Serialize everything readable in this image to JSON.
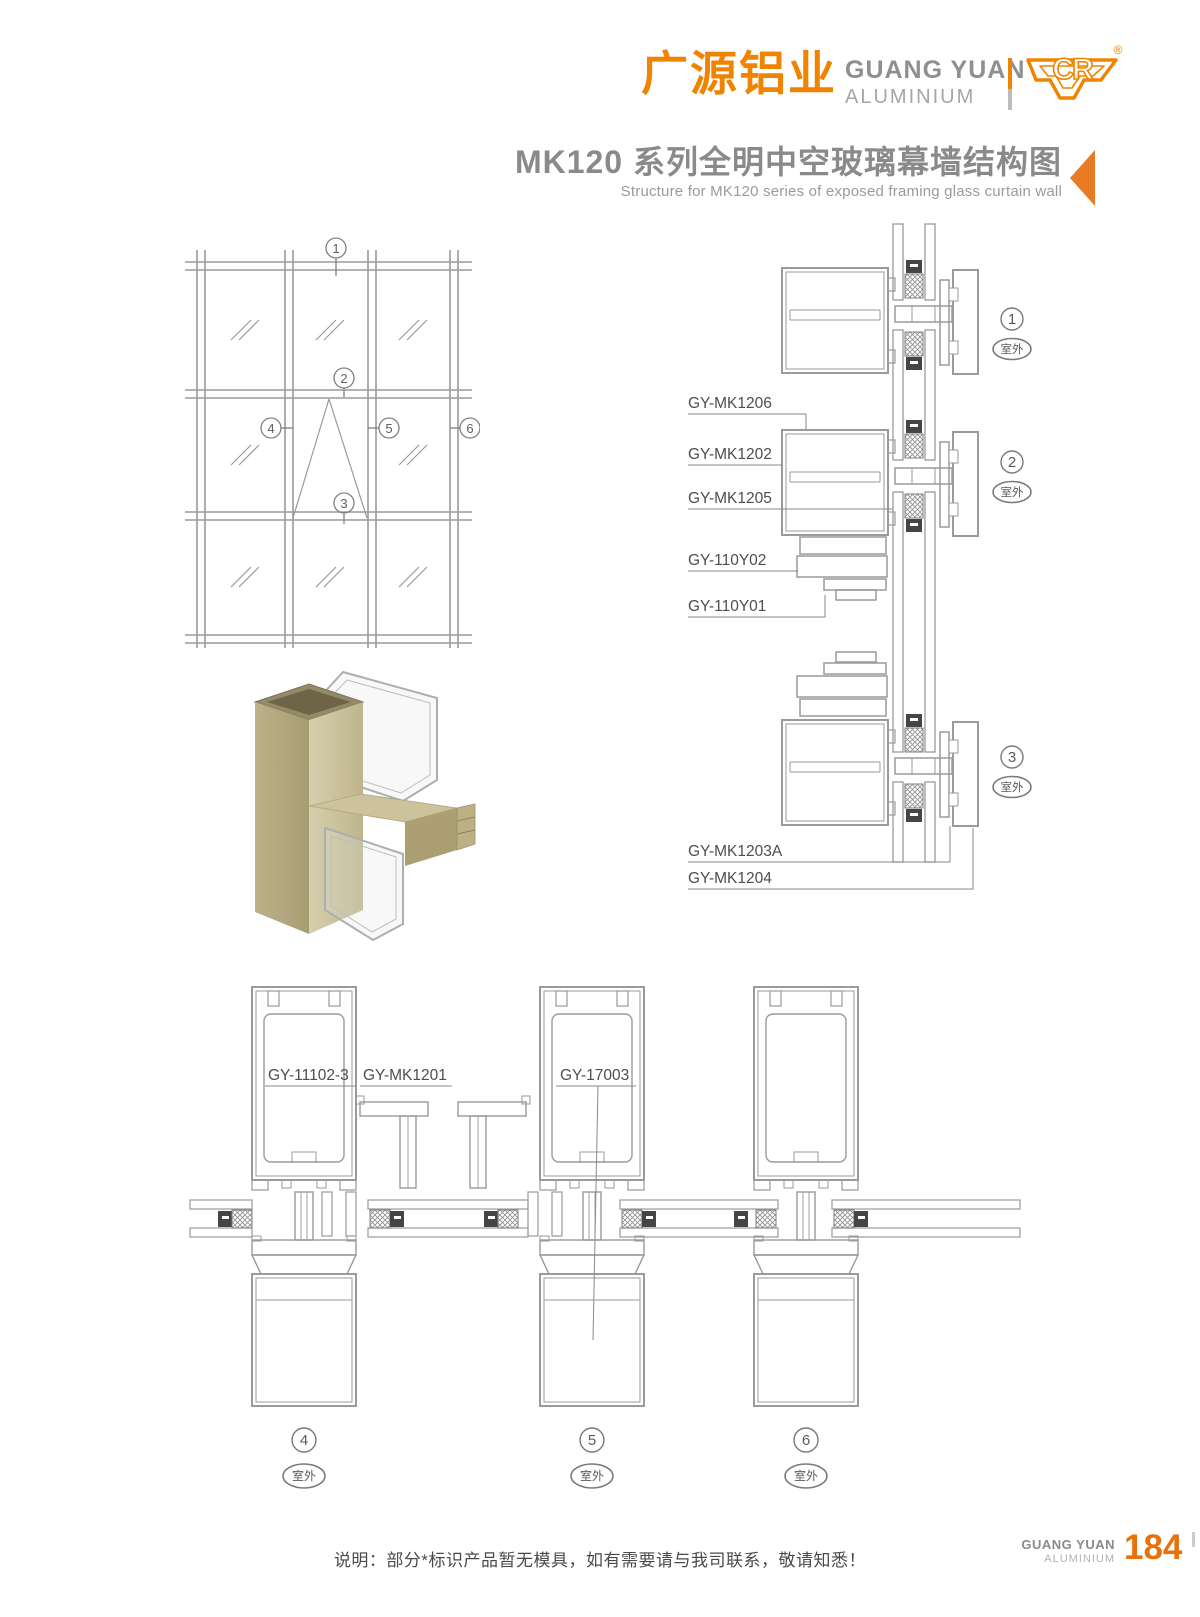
{
  "brand": {
    "cn": "广源铝业",
    "en_line1": "GUANG YUAN",
    "en_line2": "ALUMINIUM",
    "mark": "CR",
    "registered": "®"
  },
  "title": {
    "series": "MK120",
    "cn": "系列全明中空玻璃幕墙结构图",
    "en": "Structure for MK120 series of exposed framing glass curtain wall"
  },
  "elevation": {
    "callouts": [
      "1",
      "2",
      "3",
      "4",
      "5",
      "6"
    ]
  },
  "vertical_section": {
    "labels": [
      "GY-MK1206",
      "GY-MK1202",
      "GY-MK1205",
      "GY-110Y02",
      "GY-110Y01",
      "GY-MK1203A",
      "GY-MK1204"
    ],
    "callouts": [
      "1",
      "2",
      "3"
    ],
    "outdoor_label": "室外"
  },
  "horizontal_section": {
    "labels": [
      "GY-11102-3",
      "GY-MK1201",
      "GY-17003"
    ],
    "callouts": [
      "4",
      "5",
      "6"
    ],
    "outdoor_label": "室外"
  },
  "footer": {
    "note": "说明：部分*标识产品暂无模具，如有需要请与我司联系，敬请知悉！",
    "brand_line1": "GUANG YUAN",
    "brand_line2": "ALUMINIUM",
    "page_number": "184"
  },
  "colors": {
    "brand_orange": "#f08300",
    "arrow_orange": "#e87b25",
    "drawing_line": "#9a9a9a",
    "label_text": "#4f4d4d",
    "title_gray": "#8a8a8a"
  }
}
